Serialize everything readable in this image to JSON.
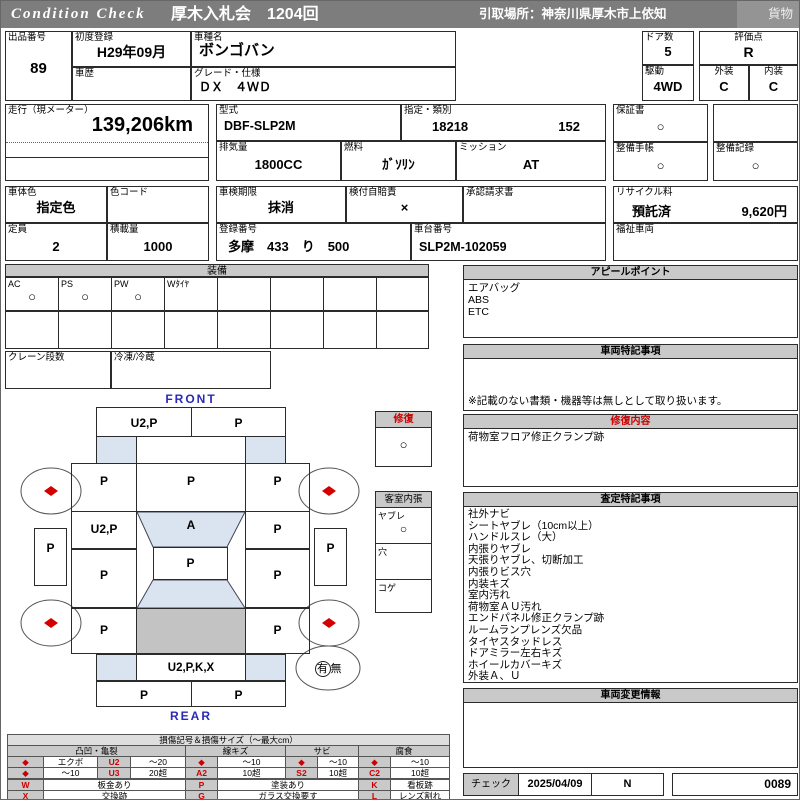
{
  "colors": {
    "accent_red": "#cc0000",
    "label_blue": "#2a2ab8",
    "glass_blue": "#d9e4f0",
    "roof_gray": "#c3c3c3",
    "bar_gray": "#7d7d7d",
    "section_gray": "#c9c9c9"
  },
  "header": {
    "brand": "Condition Check",
    "title": "厚木入札会　1204回",
    "pickup": "引取場所：神奈川県厚木市上依知",
    "category": "貨物"
  },
  "info": {
    "lot": {
      "label": "出品番号",
      "value": "89"
    },
    "first_reg": {
      "label": "初度登録",
      "value": "H29年09月"
    },
    "history": {
      "label": "車歴",
      "value": ""
    },
    "model_name": {
      "label": "車種名",
      "value": "ボンゴバン"
    },
    "grade": {
      "label": "グレード・仕様",
      "value": "ＤＸ　４ＷＤ"
    },
    "doors": {
      "label": "ドア数",
      "value": "5"
    },
    "score": {
      "label": "評価点",
      "value": "R"
    },
    "drive": {
      "label": "駆動",
      "value": "4WD"
    },
    "exterior": {
      "label": "外装",
      "value": "C"
    },
    "interior": {
      "label": "内装",
      "value": "C"
    },
    "mileage": {
      "label": "走行（現メーター）",
      "value": "139,206km"
    },
    "model_code": {
      "label": "型式",
      "value": "DBF-SLP2M"
    },
    "class_no": {
      "label": "指定・類別",
      "designation": "18218",
      "classification": "152"
    },
    "displacement": {
      "label": "排気量",
      "value": "1800CC"
    },
    "fuel": {
      "label": "燃料",
      "value": "ｶﾞｿﾘﾝ"
    },
    "transmission": {
      "label": "ミッション",
      "value": "AT"
    },
    "warranty": {
      "label": "保証書",
      "value": "○"
    },
    "maintenance_book": {
      "label": "整備手帳",
      "value": "○"
    },
    "maintenance_record": {
      "label": "整備記録",
      "value": "○"
    },
    "body_color": {
      "label": "車体色",
      "value": "指定色"
    },
    "color_code": {
      "label": "色コード",
      "value": ""
    },
    "inspection": {
      "label": "車検期限",
      "value": "抹消"
    },
    "insurance": {
      "label": "検付自賠責",
      "value": "×"
    },
    "approval": {
      "label": "承認請求書",
      "value": ""
    },
    "recycle": {
      "label": "リサイクル料",
      "status": "預託済",
      "fee": "9,620円"
    },
    "capacity": {
      "label": "定員",
      "value": "2"
    },
    "load": {
      "label": "積載量",
      "value": "1000"
    },
    "reg_no": {
      "label": "登録番号",
      "value": "多摩　433　り　500"
    },
    "chassis_no": {
      "label": "車台番号",
      "value": "SLP2M-102059"
    },
    "welfare": {
      "label": "福祉車両",
      "value": ""
    }
  },
  "equipment": {
    "title": "装備",
    "ac": {
      "label": "AC",
      "value": "○"
    },
    "ps": {
      "label": "PS",
      "value": "○"
    },
    "pw": {
      "label": "PW",
      "value": "○"
    },
    "wtire": {
      "label": "Wﾀｲﾔ",
      "value": ""
    },
    "crane": {
      "label": "クレーン段数",
      "value": ""
    },
    "fridge": {
      "label": "冷凍/冷蔵",
      "value": ""
    }
  },
  "diagram": {
    "front_label": "FRONT",
    "rear_label": "REAR",
    "front_bumper_left": "U2,P",
    "front_bumper_right": "P",
    "fender_left": "P",
    "hood": "P",
    "fender_right": "P",
    "cowl_left": "U2,P",
    "windshield": "A",
    "cowl_right": "P",
    "roof_front": "P",
    "side_left_1": "P",
    "side_right_1": "P",
    "side_left_2": "P",
    "side_right_2": "P",
    "step_left": "P",
    "step_right": "P",
    "rear_panel": "U2,P,K,X",
    "rear_bumper_left": "P",
    "rear_bumper_right": "P",
    "repair_box": {
      "title": "修復",
      "value": "○"
    },
    "cabin_box": {
      "title": "客室内張",
      "rows": [
        {
          "label": "ヤブレ",
          "value": "○"
        },
        {
          "label": "穴",
          "value": ""
        },
        {
          "label": "コゲ",
          "value": ""
        }
      ]
    },
    "spare": {
      "yes": "有",
      "no": "無"
    }
  },
  "sections": {
    "appeal": {
      "title": "アピールポイント",
      "items": [
        "エアバッグ",
        "ABS",
        "ETC"
      ]
    },
    "notes": {
      "title": "車両特記事項",
      "footnote": "※記載のない書類・機器等は無しとして取り扱います。"
    },
    "repair": {
      "title": "修復内容",
      "content": "荷物室フロア修正クランプ跡"
    },
    "assessment": {
      "title": "査定特記事項",
      "items": [
        "社外ナビ",
        "シートヤブレ（10cm以上）",
        "ハンドルスレ（大）",
        "内張りヤブレ",
        "天張りヤブレ、切断加工",
        "内張りビス穴",
        "内装キズ",
        "室内汚れ",
        "荷物室ＡＵ汚れ",
        "エンドパネル修正クランプ跡",
        "ルームランプレンズ欠品",
        "タイヤスタッドレス",
        "ドアミラー左右キズ",
        "ホイールカバーキズ",
        "外装Ａ、Ｕ"
      ]
    },
    "change": {
      "title": "車両変更情報"
    }
  },
  "check": {
    "label": "チェック",
    "date": "2025/04/09",
    "inspector": "N",
    "number": "0089"
  },
  "legend": {
    "title": "損傷記号＆損傷サイズ（～最大cm）",
    "diamond": "◆",
    "groups": [
      "凸凹・亀裂",
      "線キズ",
      "サビ",
      "腐食"
    ],
    "row1": {
      "dent_label": "エクボ",
      "dent_code": "U2",
      "dent_size": "～20",
      "scratch_size": "～10",
      "rust_size": "～10",
      "corrosion_size": "～10"
    },
    "row2": {
      "dent_label": "～10",
      "dent_code": "U3",
      "dent_size": "20超",
      "scratch_code": "A2",
      "scratch_size": "10超",
      "rust_code": "S2",
      "rust_size": "10超",
      "corrosion_code": "C2",
      "corrosion_size": "10超"
    },
    "codes": [
      {
        "code": "W",
        "label": "板金あり"
      },
      {
        "code": "P",
        "label": "塗装あり"
      },
      {
        "code": "K",
        "label": "看板跡"
      },
      {
        "code": "X",
        "label": "交換跡"
      },
      {
        "code": "G",
        "label": "ガラス交換要す"
      },
      {
        "code": "L",
        "label": "レンズ割れ"
      }
    ]
  }
}
